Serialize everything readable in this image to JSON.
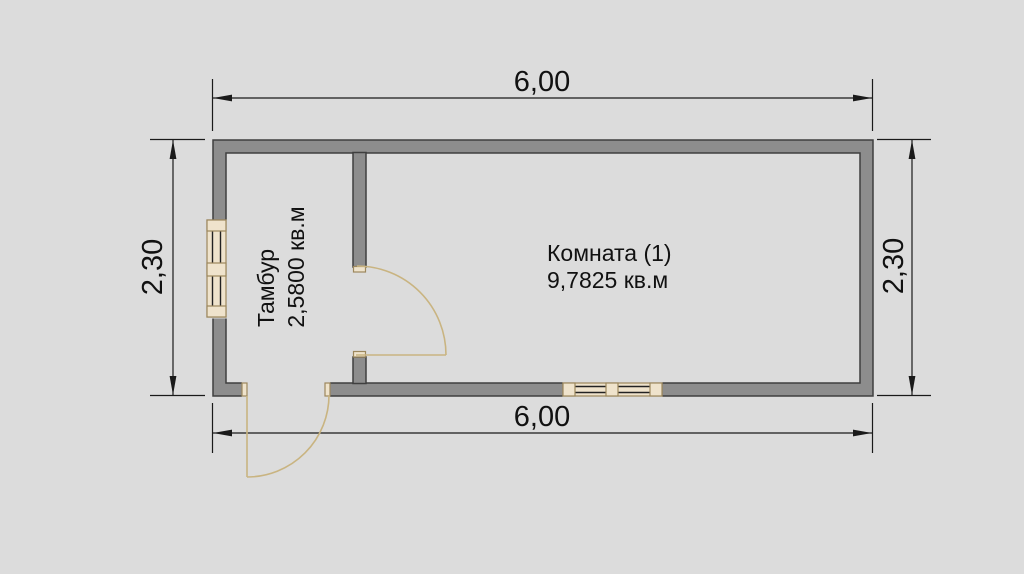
{
  "plan": {
    "rooms": [
      {
        "label": "Тамбур",
        "area": "2,5800 кв.м"
      },
      {
        "label": "Комната (1)",
        "area": "9,7825 кв.м"
      }
    ],
    "dimensions": {
      "top": "6,00",
      "bottom": "6,00",
      "left": "2,30",
      "right": "2,30"
    },
    "colors": {
      "background": "#dcdcdc",
      "wall_fill": "#8d8d8d",
      "wall_outline": "#3f3f3f",
      "dimension_lines": "#1a1a1a",
      "door_swing": "#c9b481",
      "window_fill": "#efe3cc",
      "window_frame": "#9c875d"
    }
  }
}
